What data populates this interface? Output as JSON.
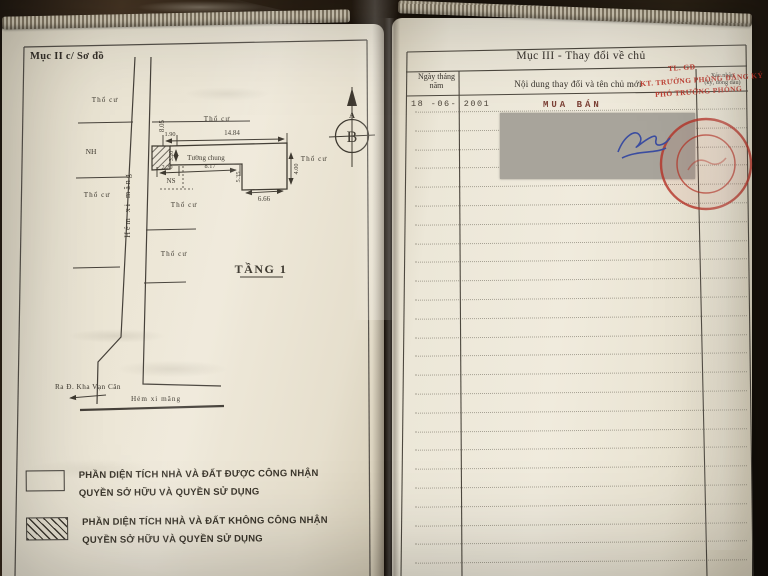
{
  "page_left": {
    "header": "Mục II c/ Sơ đồ",
    "diagram": {
      "floor_label": "TẦNG 1",
      "land_label": "Thổ cư",
      "house_label": "NH",
      "ns_label": "NS",
      "shared_wall_label": "Tường chung",
      "alley_label_vertical": "Hẻm xi măng",
      "alley_label_bottom": "Hẻm xi măng",
      "street_label": "Ra Đ. Kha Vạn Cân",
      "compass_a": "A",
      "compass_b": "B",
      "dims": {
        "front_left": "1.90",
        "front_main": "14.84",
        "side_top": "8.05",
        "hatch_depth": "3.20",
        "rear_left": "2.20",
        "shared_wall": "8.17",
        "step_depth": "5.35",
        "right_depth": "4.00",
        "rear_width": "6.66"
      }
    },
    "legend": {
      "item1_line1": "PHẦN DIỆN TÍCH NHÀ VÀ ĐẤT ĐƯỢC CÔNG NHẬN",
      "item1_line2": "QUYỀN SỞ HỮU VÀ QUYỀN SỬ DỤNG",
      "item2_line1": "PHẦN DIỆN TÍCH NHÀ VÀ ĐẤT KHÔNG CÔNG NHẬN",
      "item2_line2": "QUYỀN SỞ HỮU VÀ QUYỀN SỬ DỤNG"
    }
  },
  "page_right": {
    "header": "Mục III - Thay đổi về chủ",
    "table": {
      "col_date_line1": "Ngày tháng",
      "col_date_line2": "năm",
      "col_content": "Nội dung thay đổi và tên chủ mới",
      "col_confirm_line1": "Xác nhận",
      "col_confirm_line2": "(ký, đóng dấu)",
      "entry_date": "18 -06- 2001",
      "entry_content": "MUA BÁN"
    },
    "red_stamp": {
      "line1": "TL. GĐ",
      "line2": "KT. TRƯỞNG PHÒNG ĐĂNG KÝ",
      "line3": "PHÓ TRƯỞNG PHÒNG"
    }
  },
  "colors": {
    "page": "#ece6d8",
    "ink": "#3d382f",
    "stamp_red": "#bc3226",
    "signature_blue": "#3b4da0",
    "redaction_grey": "#a8a49b",
    "entry_ink": "#4c443a",
    "entry_red": "#7c4136"
  }
}
